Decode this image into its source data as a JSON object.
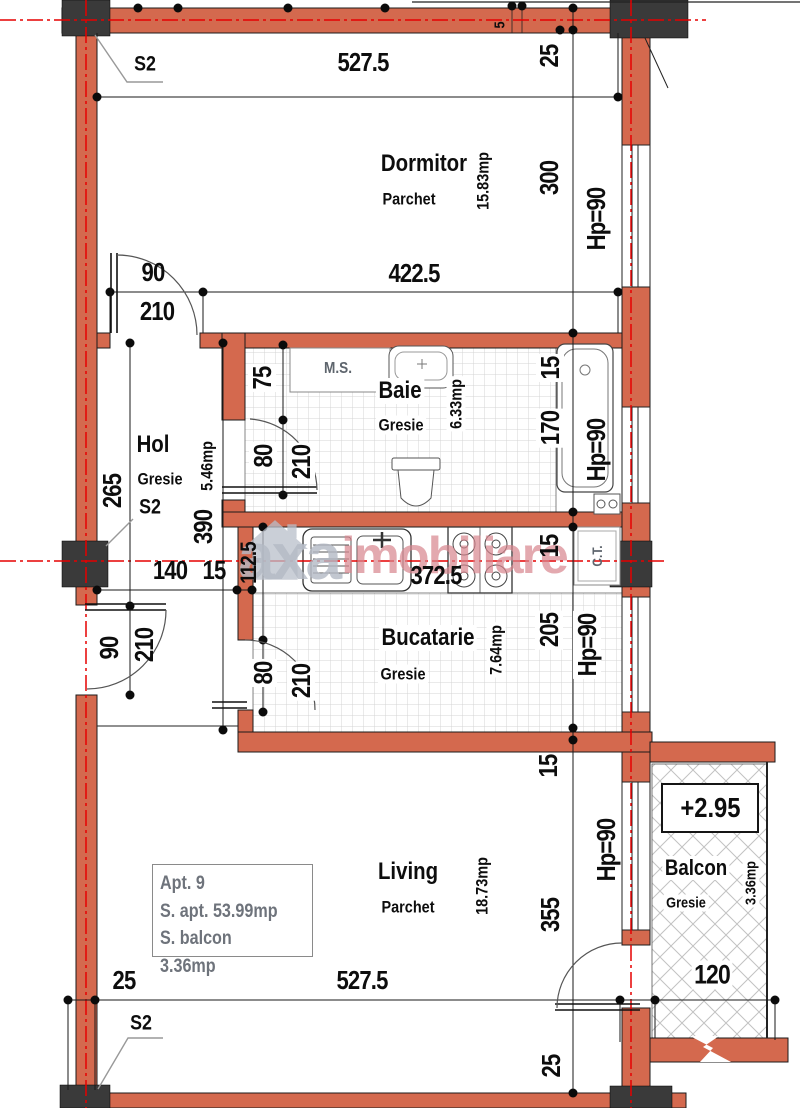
{
  "plan": {
    "watermark": {
      "brand_gray": "axa",
      "brand_pink": "imobiliare"
    },
    "info_box": {
      "line1": "Apt.  9",
      "line2": "S. apt.  53.99mp",
      "line3": "S. balcon  3.36mp"
    },
    "rooms": {
      "dormitor": {
        "name": "Dormitor",
        "floor": "Parchet",
        "area": "15.83mp"
      },
      "hol": {
        "name": "Hol",
        "floor": "Gresie",
        "area": "5.46mp"
      },
      "baie": {
        "name": "Baie",
        "floor": "Gresie",
        "area": "6.33mp"
      },
      "bucatarie": {
        "name": "Bucatarie",
        "floor": "Gresie",
        "area": "7.64mp"
      },
      "living": {
        "name": "Living",
        "floor": "Parchet",
        "area": "18.73mp"
      },
      "balcon": {
        "name": "Balcon",
        "floor": "Gresie",
        "area": "3.36mp",
        "level": "+2.95"
      }
    },
    "fixtures": {
      "washing_machine": "M.S.",
      "central_heating": "C.T."
    },
    "markers": {
      "s2_top": "S2",
      "s2_hol": "S2",
      "s2_bottom": "S2"
    },
    "window_height_label": "Hp=90",
    "dims": {
      "top": {
        "width": "527.5",
        "wall": "25",
        "offset": "5"
      },
      "dormitor": {
        "height": "300",
        "width": "422.5",
        "door_w": "90",
        "door_h": "210",
        "wall": "15"
      },
      "baie": {
        "length": "170",
        "door_offset": "75",
        "door_w": "80",
        "door_h": "210"
      },
      "hol": {
        "to_door": "265",
        "length": "390",
        "width": "140",
        "wall": "15"
      },
      "entry": {
        "door_w": "90",
        "door_h": "210"
      },
      "bucatarie": {
        "width": "372.5",
        "counter": "112.5",
        "counter_wall": "15",
        "height": "205",
        "door_w": "80",
        "door_h": "210"
      },
      "living": {
        "wall": "15",
        "height": "355"
      },
      "bottom": {
        "wall_left": "25",
        "width": "527.5",
        "wall_right": "25"
      },
      "balcon": {
        "width": "120"
      }
    },
    "colors": {
      "wall": "#d4694e",
      "column": "#3a3a3a",
      "centerline": "#e60000",
      "watermark_gray": "#b4bac5",
      "watermark_pink": "#d8858e"
    }
  }
}
